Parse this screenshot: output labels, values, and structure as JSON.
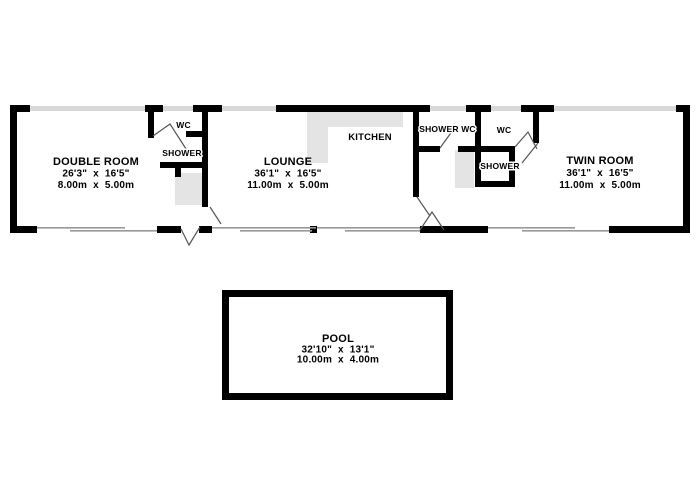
{
  "colors": {
    "wall": "#000000",
    "window": "#d8d8d8",
    "window_line": "#999999",
    "fixture": "#e4e4e4",
    "door": "#555555",
    "ink": "#000000",
    "background": "#ffffff"
  },
  "floorplan": {
    "rooms": {
      "double_room": {
        "name": "DOUBLE ROOM",
        "imperial": "26'3\"  x  16'5\"",
        "metric": "8.00m  x  5.00m"
      },
      "lounge": {
        "name": "LOUNGE",
        "imperial": "36'1\"  x  16'5\"",
        "metric": "11.00m  x  5.00m"
      },
      "twin_room": {
        "name": "TWIN ROOM",
        "imperial": "36'1\"  x  16'5\"",
        "metric": "11.00m  x  5.00m"
      },
      "pool": {
        "name": "POOL",
        "imperial": "32'10\"  x  13'1\"",
        "metric": "10.00m  x  4.00m"
      }
    },
    "labels": {
      "kitchen": "KITCHEN",
      "wc_left": "WC",
      "shower_left": "SHOWER",
      "shower_wc": "SHOWER WC",
      "wc_right": "WC",
      "shower_right": "SHOWER"
    }
  }
}
